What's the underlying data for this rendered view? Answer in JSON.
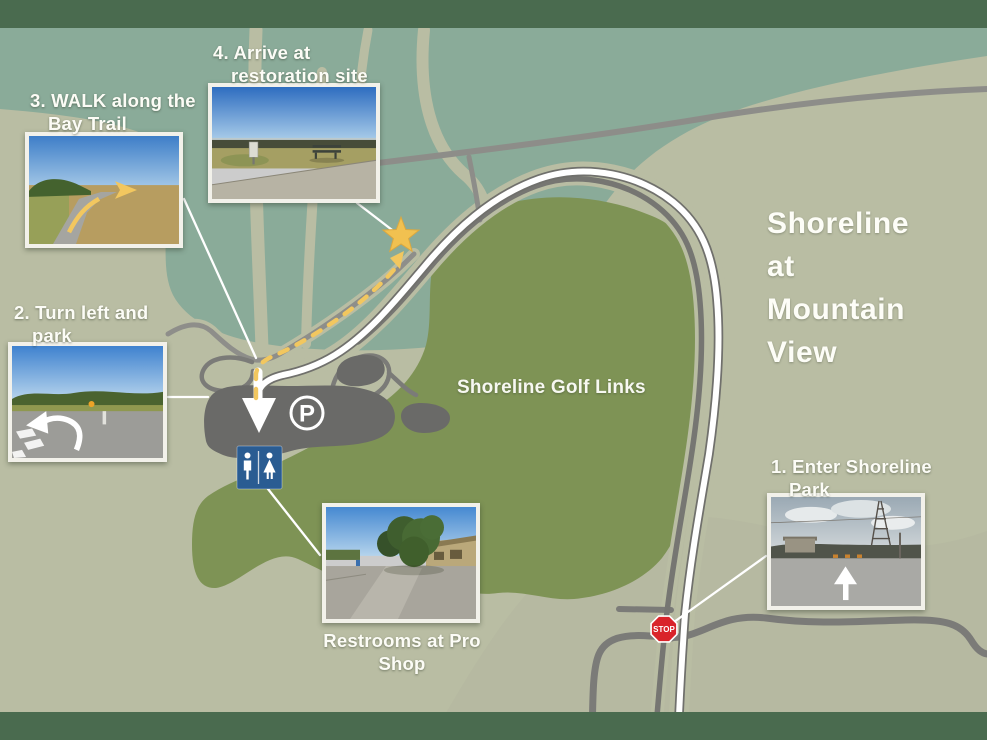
{
  "title": {
    "lines": [
      "Shoreline",
      "at",
      "Mountain",
      "View"
    ]
  },
  "map": {
    "golf_label": "Shoreline Golf Links",
    "parking_symbol": "P",
    "stop_sign_text": "STOP"
  },
  "steps": [
    {
      "num": "1",
      "lines": [
        "1. Enter Shoreline",
        "Park"
      ]
    },
    {
      "num": "2",
      "lines": [
        "2. Turn left and",
        "park"
      ]
    },
    {
      "num": "3",
      "lines": [
        "3. WALK along the",
        "Bay Trail"
      ]
    },
    {
      "num": "4",
      "lines": [
        "4. Arrive at",
        "restoration site"
      ]
    }
  ],
  "notes": {
    "restrooms": {
      "lines": [
        "Restrooms at Pro",
        "Shop"
      ]
    }
  },
  "colors": {
    "band_green": "#4a6b4f",
    "background_sage": "#b9bda3",
    "marsh_teal": "#8aab99",
    "golf_green": "#7e9355",
    "road_gray": "#7b7b78",
    "parking_gray": "#6a6a68",
    "route_white": "#ffffff",
    "trail_yellow": "#f2c75f",
    "star_gold": "#f1c150",
    "restroom_blue": "#2a5c92",
    "stop_red": "#d9232a"
  }
}
